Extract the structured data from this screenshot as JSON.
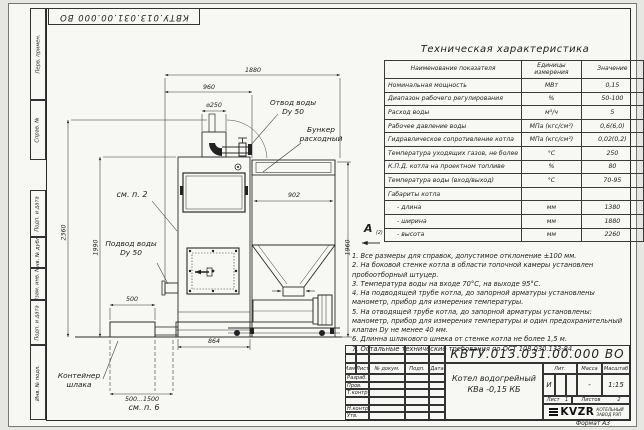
{
  "doc_number": "КВТУ.013.031.00.000 ВО",
  "frame": {
    "left_labels": [
      "Перв. примен.",
      "Справ. №",
      "Подп. и дата",
      "Инв. № дубл.",
      "Взам. инв. №",
      "Подп. и дата",
      "Инв. № подл."
    ],
    "format_label": "Формат А3"
  },
  "tech_table": {
    "title": "Техническая характеристика",
    "headers": [
      "Наименование показателя",
      "Единицы измерения",
      "Значение"
    ],
    "rows": [
      {
        "name": "Номинальная мощность",
        "unit": "МВт",
        "value": "0,15"
      },
      {
        "name": "Диапазон рабочего регулирования",
        "unit": "%",
        "value": "50-100"
      },
      {
        "name": "Расход воды",
        "unit": "м³/ч",
        "value": "5"
      },
      {
        "name": "Рабочее давление воды",
        "unit": "МПа (кгс/см²)",
        "value": "0,6(6,0)"
      },
      {
        "name": "Гидравлическое сопротивление котла",
        "unit": "МПа (кгс/см²)",
        "value": "0,02(0,2)"
      },
      {
        "name": "Температура уходящих газов, не более",
        "unit": "°С",
        "value": "250"
      },
      {
        "name": "К.П.Д. котла на проектном топливе",
        "unit": "%",
        "value": "80"
      },
      {
        "name": "Температура воды (вход/выход)",
        "unit": "°С",
        "value": "70-95"
      },
      {
        "name": "Габариты котла",
        "unit": "",
        "value": ""
      },
      {
        "name": "- длина",
        "unit": "мм",
        "value": "1380"
      },
      {
        "name": "- ширина",
        "unit": "мм",
        "value": "1880"
      },
      {
        "name": "- высота",
        "unit": "мм",
        "value": "2260"
      }
    ]
  },
  "view_marker": {
    "label": "А",
    "sub": "(2)"
  },
  "notes": {
    "items": [
      "1.  Все размеры для справок, допустимое отклонение ±100 мм.",
      "2.  На боковой стенке котла в области топочной камеры установлен пробоотборный штуцер.",
      "3.  Температура воды на входе  70°С, на выходе  95°С.",
      "4.  На подводящей трубе котла, до запорной арматуры установлены манометр, прибор для измерения температуры.",
      "5.  На отводящей трубе котла, до запорной арматуры установлены: манометр, прибор для измерения температуры и один предохранительный клапан Dу не менее  40 мм.",
      "6.  Длинна шлакового шнека от стенке котла не более  1,5 м.",
      "7.  Остальные технические требования по ОСТ  108.030.133-84."
    ]
  },
  "drawing": {
    "dims": {
      "width_total": "1880",
      "width_boiler": "960",
      "chimney_dia": "⌀250",
      "bunker_width": "902",
      "height_total": "2360",
      "height_boiler": "1990",
      "height_bunker": "1960",
      "boiler_depth": "864",
      "container_width": "500",
      "container_range": "500...1500"
    },
    "labels": {
      "otvod_line1": "Отвод воды",
      "otvod_line2": "Dy 50",
      "bunker_line1": "Бункер",
      "bunker_line2": "расходный",
      "see_item_2": "см. п. 2",
      "podvod_line1": "Подвод воды",
      "podvod_line2": "Dy 50",
      "container_line1": "Контейнер",
      "container_line2": "шлака",
      "see_item_6": "см. п. 6"
    }
  },
  "title_block": {
    "product_name_line1": "Котел водогрейный",
    "product_name_line2": "КВа -0,15  КБ",
    "col_headers": [
      "Изм.",
      "Лист",
      "№ докум.",
      "Подп.",
      "Дата"
    ],
    "row_labels": [
      "Разраб.",
      "Пров.",
      "Т.контр.",
      "",
      "Н.контр.",
      "Утв."
    ],
    "lit_label": "Лит.",
    "lit_value": "И",
    "mass_label": "Масса",
    "mass_value": "-",
    "scale_label": "Масштаб",
    "scale_value": "1:15",
    "sheet_label": "Лист",
    "sheet_value": "1",
    "sheets_label": "Листов",
    "sheets_value": "2",
    "company_logo": "KVZR",
    "company_name_line1": "КОТЕЛЬНЫЙ",
    "company_name_line2": "ЗАВОД РЭП"
  }
}
